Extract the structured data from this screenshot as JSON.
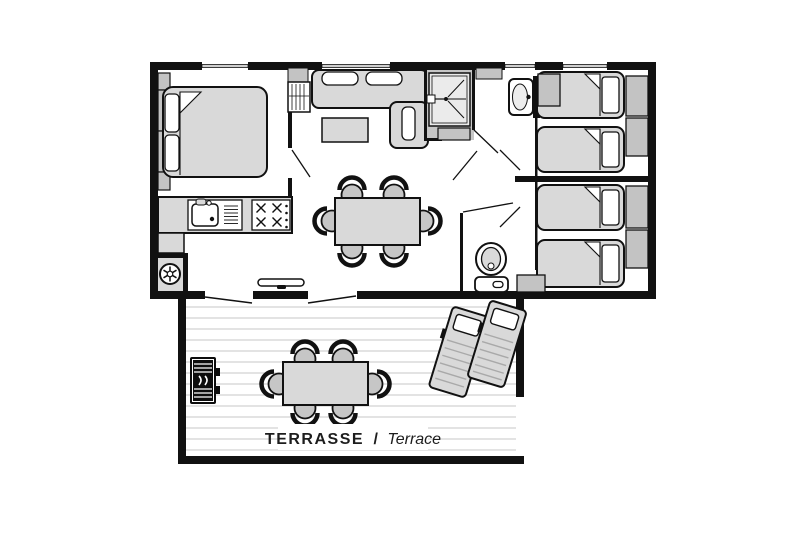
{
  "title": "Mobile home floor plan with terrace",
  "terrace": {
    "label": {
      "primary": "TERRASSE",
      "separator": "/",
      "secondary": "Terrace"
    }
  },
  "colors": {
    "wall": "#111111",
    "outline": "#1a1a1a",
    "furniture_light": "#d9d9d9",
    "furniture_mid": "#c3c3c3",
    "room_shade": "#c6c6c6",
    "decking_stripe": "#e3e3e3",
    "background": "#ffffff"
  },
  "rooms": [
    {
      "name": "bedroom-double"
    },
    {
      "name": "living-room"
    },
    {
      "name": "kitchen"
    },
    {
      "name": "shower-room"
    },
    {
      "name": "hallway"
    },
    {
      "name": "bedroom-twin-a"
    },
    {
      "name": "bedroom-twin-b"
    },
    {
      "name": "wc"
    },
    {
      "name": "terrace"
    }
  ],
  "inventory": {
    "double_beds": 1,
    "single_beds": 4,
    "indoor_dining_chairs": 6,
    "terrace_chairs": 6,
    "sun_loungers": 2,
    "stove_burners": 4,
    "bbq_grills": 1
  },
  "icons": [
    "double-bed",
    "single-bed",
    "pillow",
    "wardrobe",
    "sofa",
    "coffee-table",
    "dining-table",
    "chair",
    "kitchen-sink",
    "faucet",
    "stove",
    "washing-machine",
    "shower",
    "shower-head",
    "washbasin",
    "toilet",
    "bbq-grill",
    "sun-lounger",
    "sliding-door",
    "window",
    "door-swing"
  ]
}
